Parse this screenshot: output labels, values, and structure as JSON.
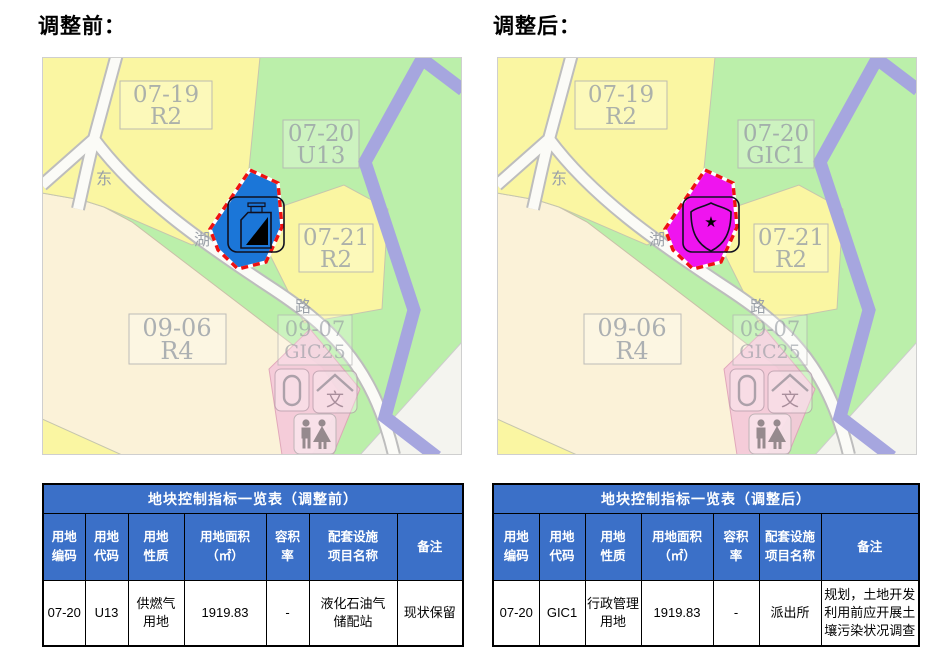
{
  "before": {
    "heading": "调整前：",
    "map": {
      "labels": {
        "p0719_l1": "07-19",
        "p0719_l2": "R2",
        "p0720_l1": "07-20",
        "p0720_l2": "U13",
        "p0721_l1": "07-21",
        "p0721_l2": "R2",
        "p0906_l1": "09-06",
        "p0906_l2": "R4",
        "p0907_l1": "09-07",
        "p0907_l2": "GIC25",
        "road_char1": "东",
        "road_char2": "湖",
        "road_char3": "路",
        "culture_char": "文"
      },
      "highlight_fill": "#1B76D8",
      "highlight_icon": "gas-storage-station"
    },
    "table": {
      "title": "地块控制指标一览表（调整前）",
      "headers": [
        "用地\n编码",
        "用地\n代码",
        "用地\n性质",
        "用地面积\n（㎡）",
        "容积\n率",
        "配套设施\n项目名称",
        "备注"
      ],
      "row": [
        "07-20",
        "U13",
        "供燃气\n用地",
        "1919.83",
        "-",
        "液化石油气\n储配站",
        "现状保留"
      ]
    }
  },
  "after": {
    "heading": "调整后：",
    "map": {
      "labels": {
        "p0719_l1": "07-19",
        "p0719_l2": "R2",
        "p0720_l1": "07-20",
        "p0720_l2": "GIC1",
        "p0721_l1": "07-21",
        "p0721_l2": "R2",
        "p0906_l1": "09-06",
        "p0906_l2": "R4",
        "p0907_l1": "09-07",
        "p0907_l2": "GIC25",
        "road_char1": "东",
        "road_char2": "湖",
        "road_char3": "路",
        "culture_char": "文"
      },
      "highlight_fill": "#EF14EF",
      "highlight_icon": "police-station"
    },
    "table": {
      "title": "地块控制指标一览表（调整后）",
      "headers": [
        "用地\n编码",
        "用地\n代码",
        "用地\n性质",
        "用地面积\n（㎡）",
        "容积\n率",
        "配套设施\n项目名称",
        "备注"
      ],
      "row": [
        "07-20",
        "GIC1",
        "行政管理\n用地",
        "1919.83",
        "-",
        "派出所",
        "规划，土地开发\n利用前应开展土\n壤污染状况调查"
      ]
    }
  },
  "colors": {
    "table_header_blue": "#3B70C8",
    "highlight_before_blue": "#1B76D8",
    "highlight_after_magenta": "#EF14EF",
    "adjust_boundary_red": "#EE1111",
    "river_purple": "#A6A6DF",
    "parcel_yellow": "#FAF6A2",
    "parcel_green": "#BBEFAA",
    "parcel_cream": "#FBF2D8",
    "parcel_pink": "#F5C9DA"
  }
}
